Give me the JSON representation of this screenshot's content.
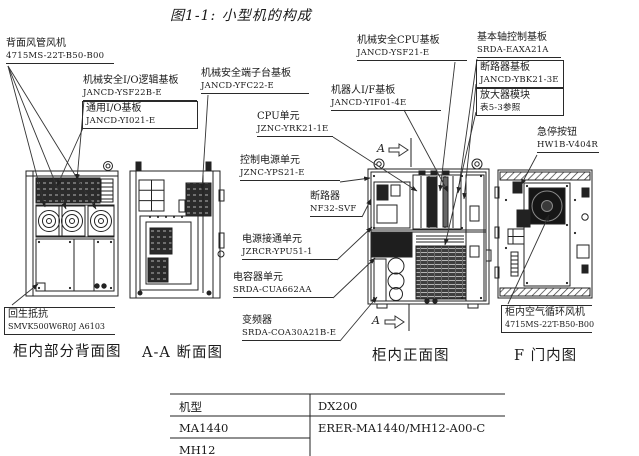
{
  "title": "图1-1: 小型机的构成",
  "callouts": {
    "rear_duct_fan": {
      "name": "背面风管风机",
      "part": "4715MS-22T-B50-B00"
    },
    "ms_io_logic_board": {
      "name": "机械安全I/O逻辑基板",
      "part": "JANCD-YSF22B-E"
    },
    "general_io_board": {
      "name": "通用I/O基板",
      "part": "JANCD-YI021-E"
    },
    "ms_terminal_board": {
      "name": "机械安全端子台基板",
      "part": "JANCD-YFC22-E"
    },
    "cpu_unit": {
      "name": "CPU单元",
      "part": "JZNC-YRK21-1E"
    },
    "control_power_unit": {
      "name": "控制电源单元",
      "part": "JZNC-YPS21-E"
    },
    "breaker": {
      "name": "断路器",
      "part": "NF32-SVF"
    },
    "power_on_unit": {
      "name": "电源接通单元",
      "part": "JZRCR-YPU51-1"
    },
    "capacitor_unit": {
      "name": "电容器单元",
      "part": "SRDA-CUA662AA"
    },
    "inverter": {
      "name": "变频器",
      "part": "SRDA-COA30A21B-E"
    },
    "ms_cpu_board": {
      "name": "机械安全CPU基板",
      "part": "JANCD-YSF21-E"
    },
    "robot_if_board": {
      "name": "机器人I/F基板",
      "part": "JANCD-YIF01-4E"
    },
    "basic_axis_board": {
      "name": "基本轴控制基板",
      "part": "SRDA-EAXA21A"
    },
    "breaker_board": {
      "name": "断路器基板",
      "part": "JANCD-YBK21-3E"
    },
    "amplifier_module": {
      "name": "放大器模块",
      "part": "表5-3参照"
    },
    "estop_button": {
      "name": "急停按钮",
      "part": "HW1B-V404R"
    },
    "regen_resistor": {
      "name": "回生抵抗",
      "part": "SMVK500W6R0J  A6103"
    },
    "cabinet_air_fan": {
      "name": "柜内空气循环风机",
      "part": "4715MS-22T-B50-B00"
    }
  },
  "captions": {
    "rear_view": "柜内部分背面图",
    "section_view": "A-A 断面图",
    "front_view": "柜内正面图",
    "door_view": "F 门内图"
  },
  "section_markers": {
    "top": "A",
    "bottom": "A"
  },
  "table": {
    "header": [
      "机型",
      "DX200"
    ],
    "rows": [
      [
        "MA1440",
        "ERER-MA1440/MH12-A00-C"
      ],
      [
        "MH12",
        ""
      ]
    ]
  },
  "colors": {
    "line": "#222222",
    "background": "#ffffff"
  }
}
